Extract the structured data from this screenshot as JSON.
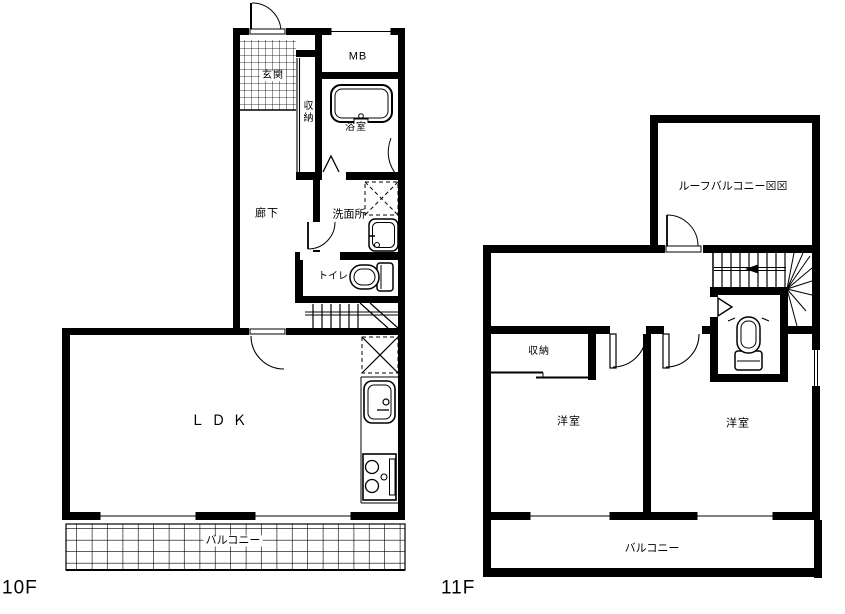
{
  "plan_title": "apartment-floor-plan",
  "colors": {
    "line": "#000000",
    "background": "#ffffff"
  },
  "floor_10f": {
    "floor_label": "10F",
    "rooms": {
      "genkan": "玄関",
      "mb": "MB",
      "bathroom": "浴室",
      "closet": "収納",
      "hallway": "廊下",
      "washroom": "洗面所",
      "toilet": "トイレ",
      "ldk": "ＬＤＫ",
      "balcony": "バルコニー"
    }
  },
  "floor_11f": {
    "floor_label": "11F",
    "rooms": {
      "roof_balcony": "ルーフバルコニー⊠⊠",
      "closet": "収納",
      "western_room_left": "洋室",
      "western_room_right": "洋室",
      "balcony": "バルコニー"
    }
  }
}
